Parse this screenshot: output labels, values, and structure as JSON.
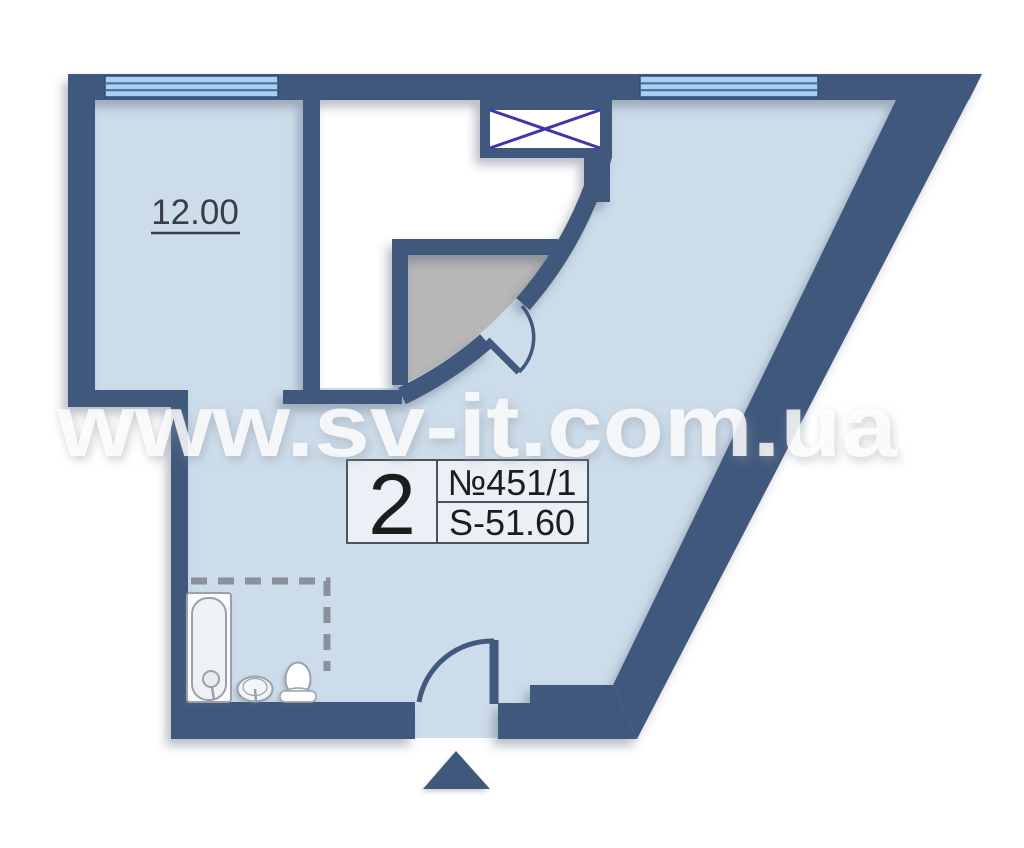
{
  "watermark": {
    "text": "www.sv-it.com.ua"
  },
  "rooms": {
    "living": {
      "area_label": "12.00"
    }
  },
  "unit_info": {
    "rooms_count": "2",
    "apartment_number": "№451/1",
    "area": "S-51.60"
  },
  "icons": {
    "vent_shaft": "crossed-box",
    "entrance_arrow": "triangle-up",
    "window": "triple-pane-strip",
    "door": "quarter-arc-swing",
    "bathtub": "tub-outline",
    "sink": "round-basin",
    "toilet": "bowl-and-tank"
  },
  "colors": {
    "wall": "#41597c",
    "floor": "#cddcea",
    "void": "#ffffff",
    "closet": "#b7b7b7",
    "window": "#a7d0f2",
    "window_frame": "#4a6d96",
    "vent_cross": "#3d37ab",
    "dashed_boundary": "#8a919c",
    "fixture_stroke": "#99a1ab",
    "box_border": "#4d525a",
    "box_fill": "#edf1f5",
    "label_text": "#1d1d1d",
    "room_label_text": "#3a3e44",
    "watermark": "#ffffff"
  }
}
